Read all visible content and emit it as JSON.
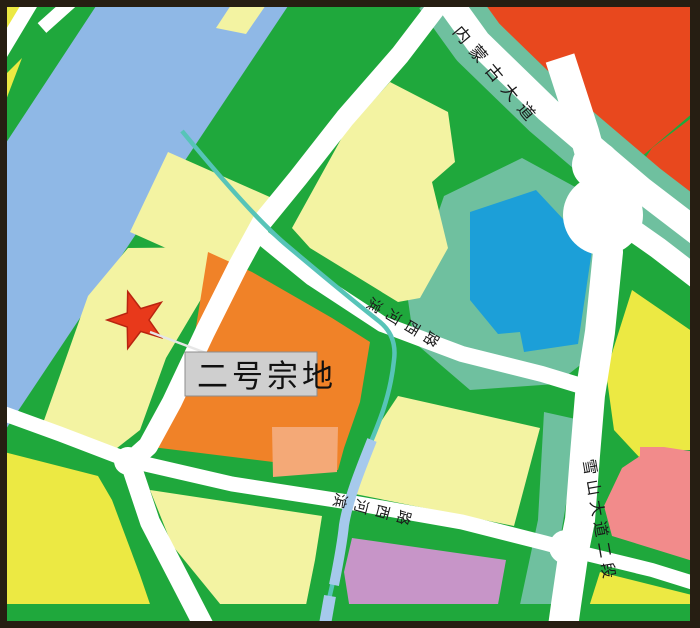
{
  "map": {
    "description": "land parcel planning map with highlighted parcel",
    "parcel_marker": {
      "label": "二号宗地",
      "marker_shape": "red five-point star"
    },
    "road_labels": {
      "top_avenue": "内蒙古大道",
      "middle_road": "滨河西路",
      "lower_road": "滨河西路",
      "right_avenue": "雪山大道二段"
    },
    "colors": {
      "frame": "#261e12",
      "green_base": "#1fa83c",
      "seafoam": "#6fc09f",
      "river_blue": "#8fb8e6",
      "stream_teal": "#57c4b8",
      "stream_light_blue": "#a6c9ec",
      "parcel_light_yellow": "#f3f3a2",
      "parcel_bright_yellow": "#ece943",
      "parcel_orange": "#f08228",
      "parcel_salmon": "#f4a977",
      "parcel_red": "#e8481e",
      "parcel_blue": "#1c9fd8",
      "parcel_pink": "#f28b8b",
      "parcel_purple": "#c795c8",
      "road_white": "#ffffff",
      "label_box_fill": "#cfcfcf",
      "label_box_border": "#8c8c8c",
      "star_red": "#e8391b"
    }
  }
}
